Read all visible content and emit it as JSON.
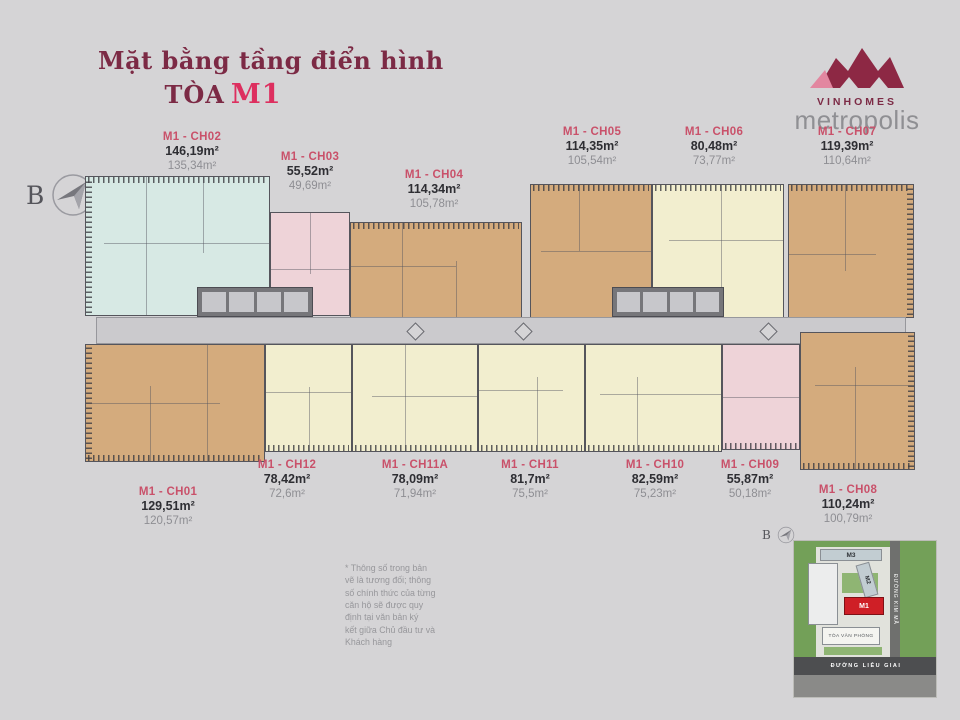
{
  "header": {
    "title": "Mặt bằng tầng điển hình",
    "tower_prefix": "TÒA",
    "tower_name": "M1"
  },
  "logo": {
    "brand": "VINHOMES",
    "sub": "metropolis"
  },
  "compass": {
    "north_label": "B"
  },
  "units": [
    {
      "code": "M1 - CH02",
      "gross": "146,19m²",
      "net": "135,34m²"
    },
    {
      "code": "M1 - CH03",
      "gross": "55,52m²",
      "net": "49,69m²"
    },
    {
      "code": "M1 - CH04",
      "gross": "114,34m²",
      "net": "105,78m²"
    },
    {
      "code": "M1 - CH05",
      "gross": "114,35m²",
      "net": "105,54m²"
    },
    {
      "code": "M1 - CH06",
      "gross": "80,48m²",
      "net": "73,77m²"
    },
    {
      "code": "M1 - CH07",
      "gross": "119,39m²",
      "net": "110,64m²"
    },
    {
      "code": "M1 - CH01",
      "gross": "129,51m²",
      "net": "120,57m²"
    },
    {
      "code": "M1 - CH12",
      "gross": "78,42m²",
      "net": "72,6m²"
    },
    {
      "code": "M1 - CH11A",
      "gross": "78,09m²",
      "net": "71,94m²"
    },
    {
      "code": "M1 - CH11",
      "gross": "81,7m²",
      "net": "75,5m²"
    },
    {
      "code": "M1 - CH10",
      "gross": "82,59m²",
      "net": "75,23m²"
    },
    {
      "code": "M1 - CH09",
      "gross": "55,87m²",
      "net": "50,18m²"
    },
    {
      "code": "M1 - CH08",
      "gross": "110,24m²",
      "net": "100,79m²"
    }
  ],
  "disclaimer": {
    "lines": [
      "* Thông số trong bản",
      "vẽ là tương đối; thông",
      "số chính thức của từng",
      "căn hộ sẽ được quy",
      "định tại văn bản ký",
      "kết giữa Chủ đầu tư và",
      "Khách hàng"
    ]
  },
  "minimap": {
    "m3": "M3",
    "m2": "M2",
    "m1": "M1",
    "office": "TÒA VĂN PHÒNG",
    "street_bottom": "ĐƯỜNG LIỄU GIAI",
    "street_right": "ĐƯỜNG KIM MÃ",
    "compass_label": "B"
  },
  "colors": {
    "maroon": "#7c2a45",
    "accent": "#dd2f5f",
    "unitCode": "#c9516a",
    "tan": "#d4ab7d",
    "cream": "#f2eecf",
    "cyan": "#d7e9e4",
    "pinkUnit": "#eed3d8",
    "core": "#76767a",
    "corridor": "#cbcacd",
    "highlightRed": "#cf1f26"
  }
}
